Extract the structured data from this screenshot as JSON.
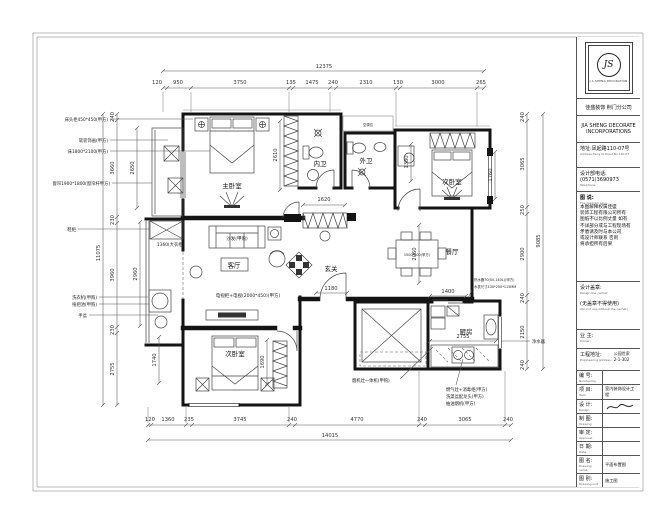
{
  "plan": {
    "rooms": {
      "master": "主卧室",
      "bed2": "次卧室",
      "bed3": "次卧室",
      "living": "客厅",
      "dining": "餐厅",
      "kitchen": "厨房",
      "bath_in": "内卫",
      "bath_out": "外卫",
      "foyer": "玄关"
    },
    "furniture": {
      "sofa": "沙发(甲购)",
      "tv": "电视柜+电视(2000*450)(甲方)",
      "dining_table": "1500*800(甲方)",
      "ac": "空调位",
      "wardrobe_dim": "1360(大衣柜)"
    },
    "annotations": {
      "left": [
        "床头柜450*450(甲方)",
        "软装饰画(甲方)",
        "床1800*2100(甲方)",
        "窗帘1900*1800(窗帘杆甲方)",
        "鞋柜",
        "洗衣机(甲购)",
        "拖把池(甲购)",
        "手盆"
      ],
      "kitchen": [
        "烟机灶一体机(甲购)",
        "燃气灶+消毒柜(甲方)",
        "洗菜盆配龙头(甲方)",
        "抽油烟机(甲方)"
      ],
      "right": [
        "热水器70(50-140L)(甲方)",
        "水表尺寸430*250*115MM",
        "净水器"
      ]
    },
    "dims": {
      "top_total": "12375",
      "top": [
        "120",
        "950",
        "3750",
        "135",
        "1475",
        "240",
        "2310",
        "130",
        "3000",
        "265"
      ],
      "bottom_total": "14015",
      "bottom": [
        "120",
        "1360",
        "235",
        "3745",
        "240",
        "4770",
        "240",
        "3065",
        "240"
      ],
      "left_total": "11075",
      "left": [
        "240",
        "3660",
        "230",
        "3960",
        "230",
        "2755"
      ],
      "left_inner": [
        "2650",
        "2960"
      ],
      "right_total": "9085",
      "right": [
        "240",
        "3065",
        "250",
        "2900",
        "240",
        "2150",
        "240"
      ],
      "inner": {
        "master": "2610",
        "corridor": "1620",
        "desk": "1380",
        "bed2": "1760",
        "dining": "2060",
        "tv": "1180",
        "kdoor": "1400",
        "counter": "2755",
        "bed3a": "1740",
        "bed3b": "1690"
      }
    }
  },
  "title_block": {
    "logo": {
      "initials": "JS",
      "caption": "J A SHENG DECORATION"
    },
    "company_cn": "佳盛装饰 荆门分公司",
    "company_en_1": "JIA SHENG DECORATE",
    "company_en_2": "INCORPORATIONS",
    "address_cn": "地址:凤起路110-07号",
    "address_en": "Address:Feng Qi Road No.110-07",
    "phone_cn": "设计部电话:(0571)3690973",
    "phone_en": "Telephone:",
    "note_title_cn": "图 说:",
    "note_title_en": "The diagram says:",
    "note_lines": [
      "本图解释权属佳盛",
      "装饰工程有限公司所有",
      "图纸不以比例丈量 如有",
      "不详部分或与工程现场有",
      "矛盾请及时与本公司",
      "或设计师联系 否则",
      "将承担所有后果"
    ],
    "stamp_label": "设计盖章:",
    "stamp_en": "Design the cachet:",
    "stamp_note": "(无盖章不得使用)",
    "stamp_note_en": "(Do not use without the cachet)",
    "owner_label": "业 主:",
    "owner_en": "Owner:",
    "site_label": "工程地址:",
    "site_en": "Engineering address:",
    "site_value_1": "公园世家",
    "site_value_2": "2-1-302",
    "rows": [
      {
        "label": "编 号:",
        "en": "Numbering",
        "value": ""
      },
      {
        "label": "项 目:",
        "en": "Item",
        "value": "室内装饰设计工程"
      },
      {
        "label": "设 计:",
        "en": "Design",
        "value": ""
      },
      {
        "label": "制 图:",
        "en": "Drawing",
        "value": ""
      },
      {
        "label": "审 定:",
        "en": "Approval",
        "value": ""
      },
      {
        "label": "日 期:",
        "en": "Date",
        "value": ""
      },
      {
        "label": "图 名:",
        "en": "Drawing name",
        "value": "平面布置图"
      },
      {
        "label": "图 别:",
        "en": "Drawing sort",
        "value": "施工图"
      },
      {
        "label": "图 号:",
        "en": "Drawing number",
        "value": "03"
      }
    ]
  }
}
